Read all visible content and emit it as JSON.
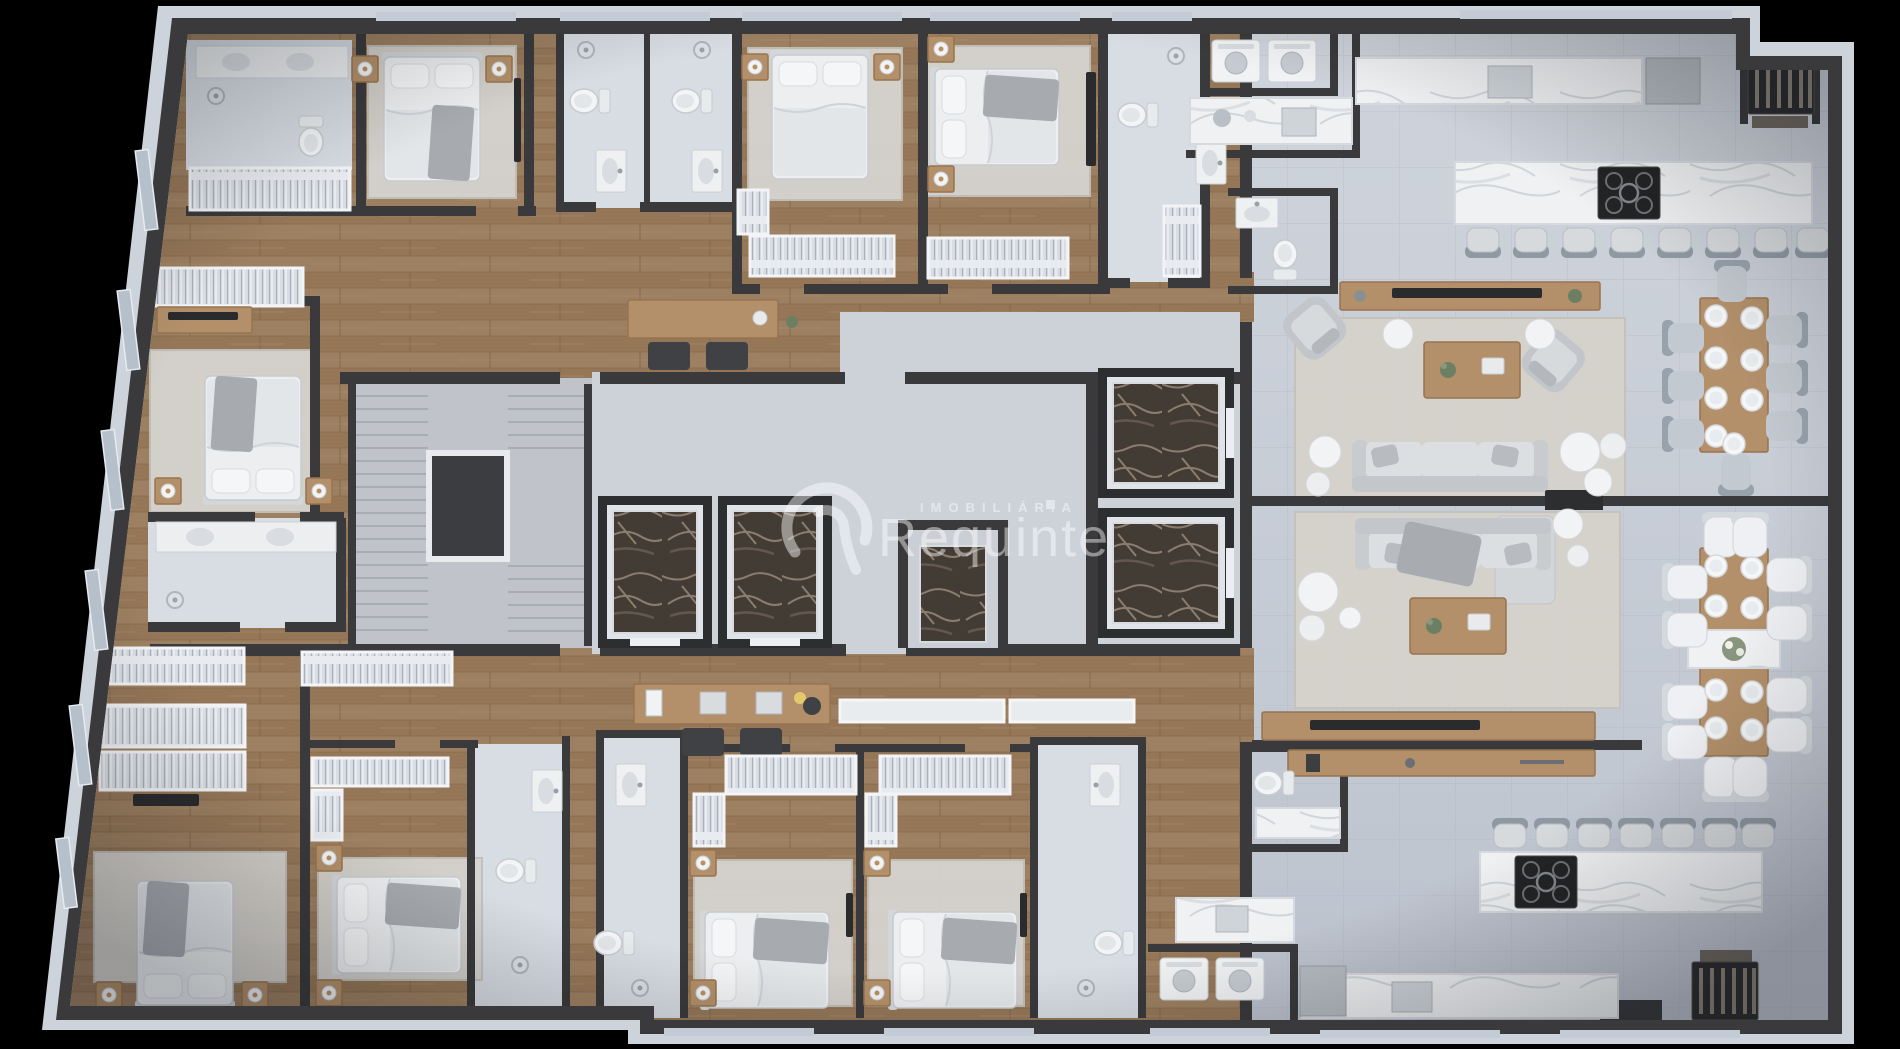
{
  "watermark": {
    "brand": "Requinte",
    "category": "IMOBILIÁRIA",
    "logo": "r-circle-monogram"
  },
  "scene": {
    "type": "apartment-floor-plan-3d-render",
    "background": "black"
  },
  "palette": {
    "bg": "#000000",
    "wall": "#3a3a3c",
    "wallDark": "#2d2e30",
    "band": "#ccd3da",
    "tileA": "#cfd4dc",
    "tileB": "#bcc2cd",
    "grout": "#aab0bc",
    "wood": "#9d8061",
    "woodDark": "#7f6448",
    "woodFurniture": "#b3906a",
    "woodFurnitureDark": "#97744f",
    "white": "#eceef0",
    "softWhite": "#f4f6f7",
    "gray": "#c6c9cd",
    "grayDark": "#9aa3ad",
    "rug": "#d6d4d0",
    "marble": "#eff1f3",
    "marbleVein": "#c9ced3",
    "marbleDark": "#433c35",
    "marbleDarkVein": "#b9a894",
    "concrete": "#c0c4ca",
    "steel": "#8d9298",
    "plant": "#6d7f62"
  }
}
